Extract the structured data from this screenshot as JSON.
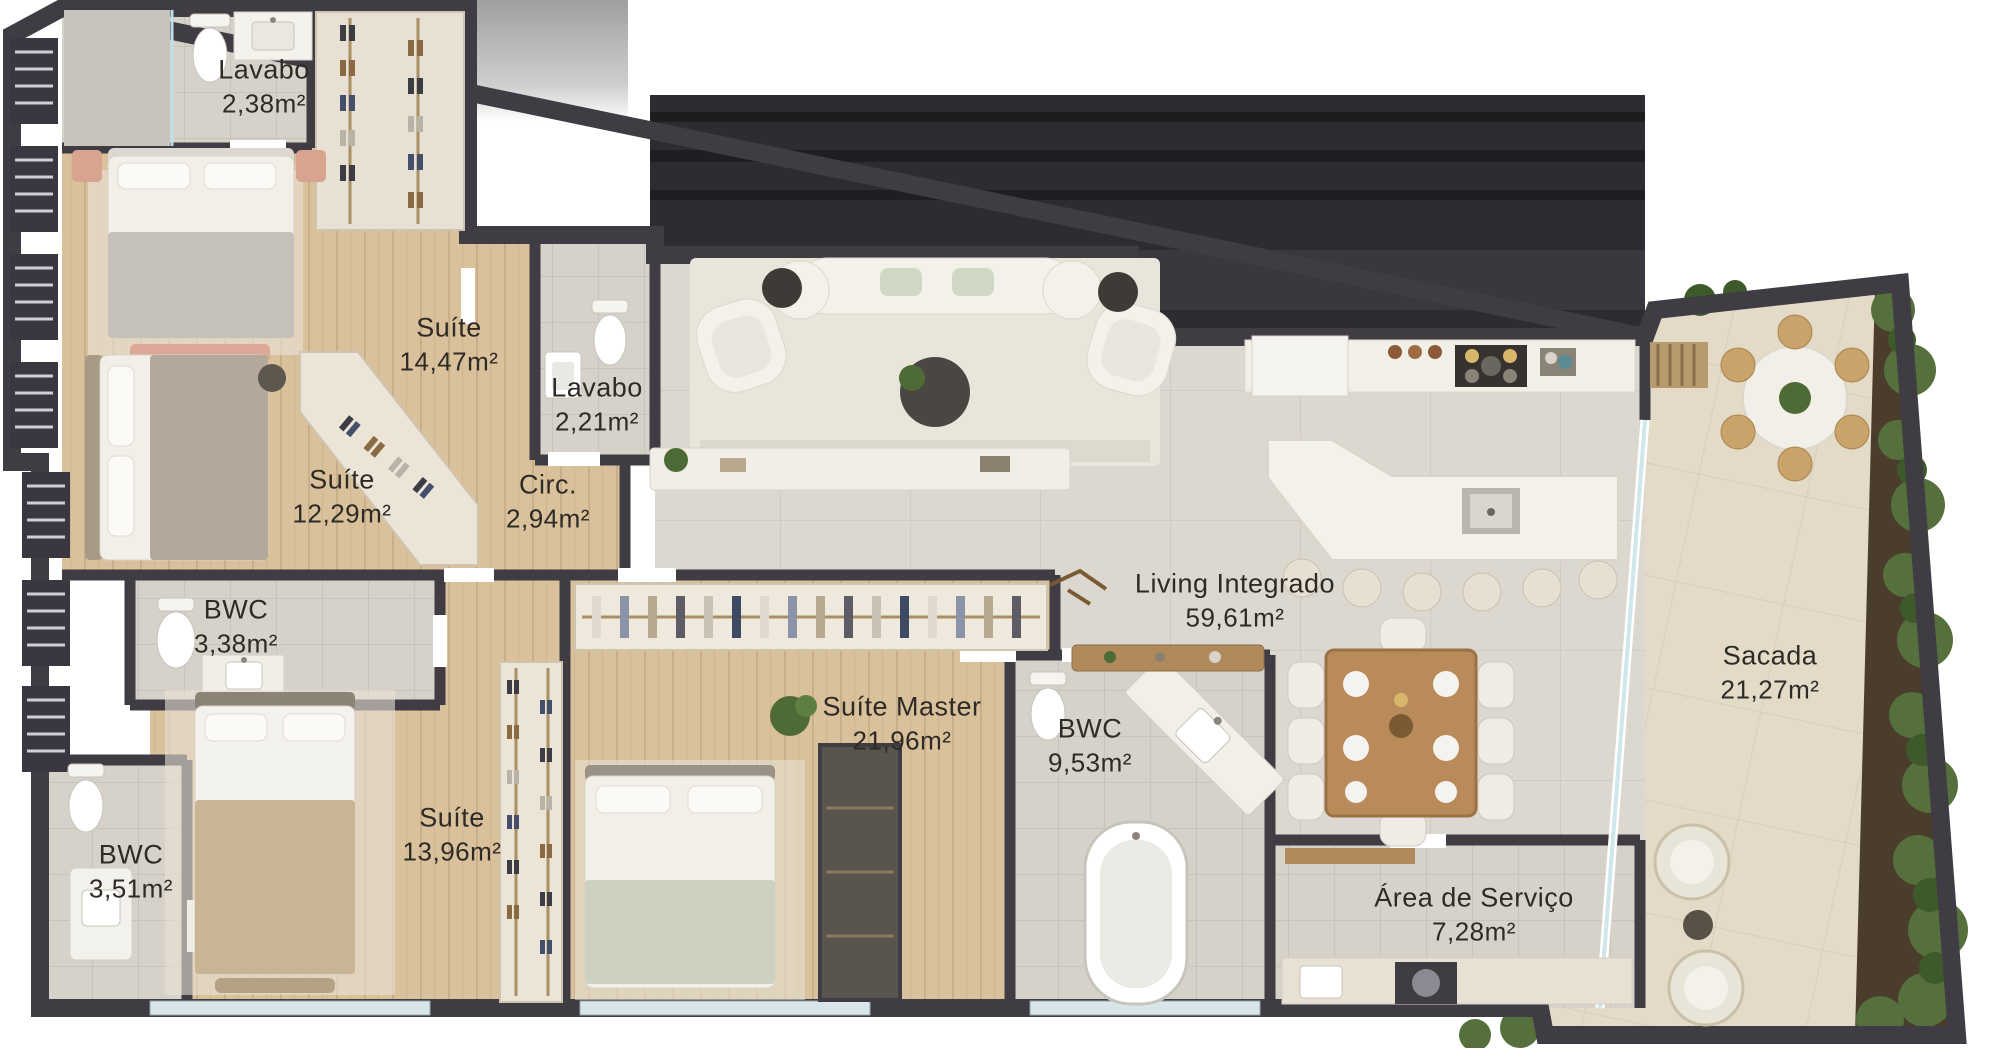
{
  "plan": {
    "type": "apartment-floor-plan",
    "language": "pt-BR",
    "rooms": [
      {
        "name": "Lavabo",
        "area": "2,38m²"
      },
      {
        "name": "Suíte",
        "area": "14,47m²"
      },
      {
        "name": "Lavabo",
        "area": "2,21m²"
      },
      {
        "name": "Suíte",
        "area": "12,29m²"
      },
      {
        "name": "Circ.",
        "area": "2,94m²"
      },
      {
        "name": "BWC",
        "area": "3,38m²"
      },
      {
        "name": "BWC",
        "area": "3,51m²"
      },
      {
        "name": "Suíte",
        "area": "13,96m²"
      },
      {
        "name": "Suíte Master",
        "area": "21,96m²"
      },
      {
        "name": "BWC",
        "area": "9,53m²"
      },
      {
        "name": "Living Integrado",
        "area": "59,61m²"
      },
      {
        "name": "Sacada",
        "area": "21,27m²"
      },
      {
        "name": "Área de Serviço",
        "area": "7,28m²"
      }
    ],
    "colors": {
      "wall": "#3f3c44",
      "wood_floor": "#d9c19b",
      "bath_tile": "#d7d2c9",
      "living_tile": "#dcd8cf",
      "balcony_stone": "#e3dbc8",
      "greenery": "#55703c",
      "glass": "#cfe6ea",
      "label_text": "#2e2a26",
      "dark_void": "#2f2c31"
    }
  }
}
